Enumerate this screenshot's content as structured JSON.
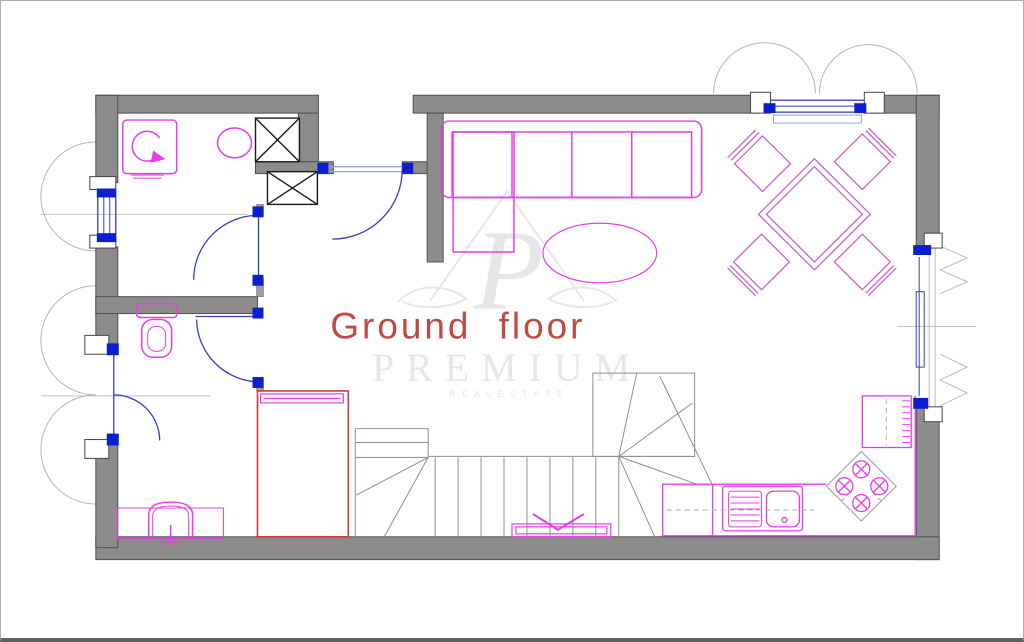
{
  "title": {
    "text": "Ground floor",
    "color": "#bf4a45"
  },
  "watermark": {
    "monogram": "P",
    "name": "PREMIUM",
    "subtitle": "R E A L   E S T A T E",
    "color": "#e7e7e7"
  },
  "colors": {
    "background": "#ffffff",
    "wall_fill": "#8c8c8c",
    "wall_edge": "#4f4f4f",
    "thin_wall": "#9f9f9f",
    "shaft_edge": "#1a1a1a",
    "furniture_magenta": "#e93ce9",
    "kitchen_magenta": "#ea3aea",
    "dining_pink": "#cb63cb",
    "door_blue": "#3340c0",
    "leaf_blue": "#96a4da",
    "hinge_blue": "#0b1fd0",
    "stairs_gray": "#8f8f8f",
    "hob_gray": "#9a9a9a",
    "shutter_gray": "#b5b5b5",
    "centerline_gray": "#c2c2c2",
    "window_gray": "#bbbbbb",
    "closet_red": "#cf3a3a",
    "border_gray": "#a8a8a8"
  }
}
